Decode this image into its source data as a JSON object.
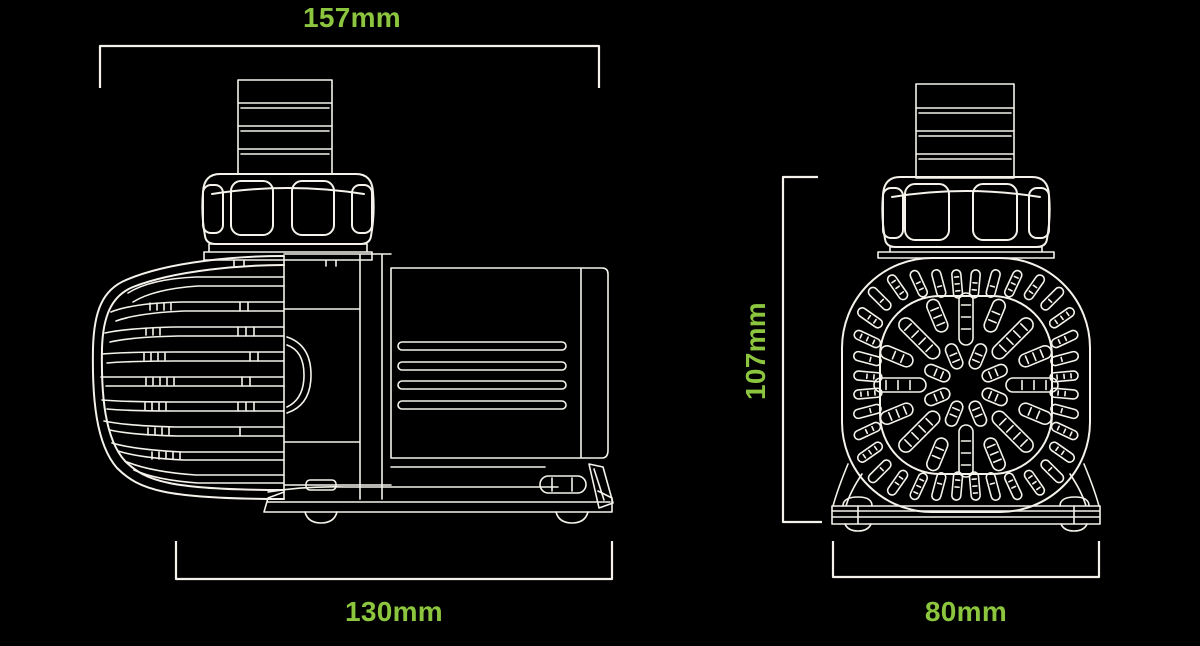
{
  "colors": {
    "background": "#000000",
    "linework": "#F4F2EA",
    "dimension_text": "#8CC63F"
  },
  "diagram": {
    "description": "Two-view technical line drawing of a water pump with dimension callouts",
    "views": [
      {
        "id": "side-view",
        "parts": [
          "hose-barb-outlet",
          "union-nut",
          "intake-grille",
          "motor-body",
          "power-cord-gland",
          "base-plate"
        ]
      },
      {
        "id": "front-view",
        "parts": [
          "hose-barb-outlet",
          "union-nut",
          "front-grille",
          "base-plate"
        ]
      }
    ],
    "dimensions": {
      "side_top_width": "157mm",
      "side_bottom_width": "130mm",
      "front_height": "107mm",
      "front_bottom_width": "80mm"
    }
  }
}
